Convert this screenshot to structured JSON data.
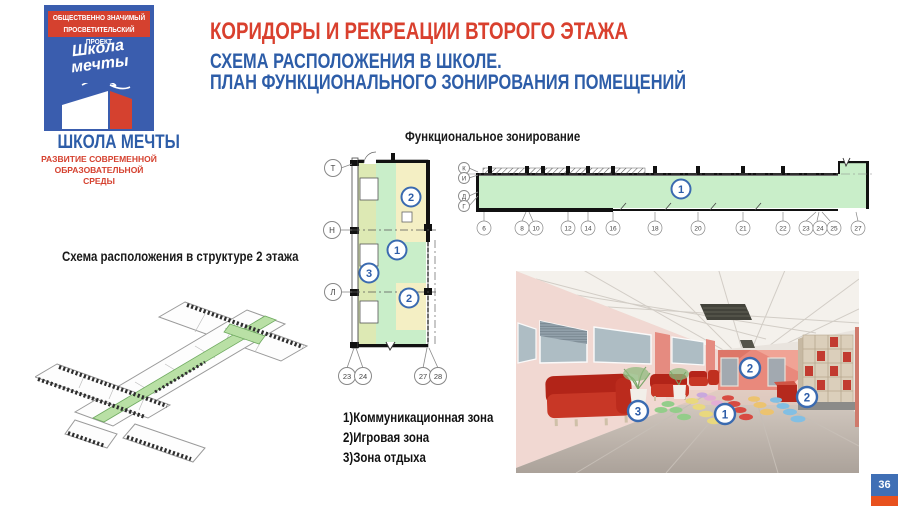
{
  "page": {
    "number": "36"
  },
  "logo": {
    "banner_line1": "ОБЩЕСТВЕННО ЗНАЧИМЫЙ",
    "banner_line2": "ПРОСВЕТИТЕЛЬСКИЙ ПРОЕКТ",
    "script_line1": "Школа",
    "script_line2": "мечты",
    "name": "ШКОЛА МЕЧТЫ",
    "tagline_line1": "РАЗВИТИЕ СОВРЕМЕННОЙ",
    "tagline_line2": "ОБРАЗОВАТЕЛЬНОЙ СРЕДЫ"
  },
  "header": {
    "title": "КОРИДОРЫ И РЕКРЕАЦИИ ВТОРОГО ЭТАЖА",
    "subtitle_line1": "СХЕМА РАСПОЛОЖЕНИЯ В ШКОЛЕ.",
    "subtitle_line2": "ПЛАН ФУНКЦИОНАЛЬНОГО ЗОНИРОВАНИЯ ПОМЕЩЕНИЙ"
  },
  "sections": {
    "functional_zoning_title": "Функциональное зонирование",
    "structure_scheme_title": "Схема расположения в структуре 2 этажа"
  },
  "legend": {
    "items": [
      {
        "label": "1)Коммуникационная зона"
      },
      {
        "label": "2)Игровая зона"
      },
      {
        "label": "3)Зона отдыха"
      }
    ]
  },
  "vertical_plan": {
    "axis_left": [
      "Т",
      "Н",
      "Л"
    ],
    "axis_bottom": [
      "23",
      "24",
      "27",
      "28"
    ],
    "zones": [
      "2",
      "1",
      "3",
      "2"
    ]
  },
  "horizontal_plan": {
    "axis_left": [
      "К",
      "И",
      "Д",
      "Г"
    ],
    "axis_bottom": [
      "6",
      "8",
      "10",
      "12",
      "14",
      "16",
      "18",
      "20",
      "21",
      "22",
      "23",
      "24",
      "25",
      "27"
    ],
    "zone_label": "1"
  },
  "photo": {
    "markers": [
      "3",
      "1",
      "2",
      "2"
    ]
  },
  "colors": {
    "accent_red": "#d9402e",
    "accent_blue": "#2d5da8",
    "zone_green": "#c9eec9",
    "zone_yellow": "#f4efc4",
    "zone_olive": "#dde9b4",
    "badge_blue": "#3f6fb5",
    "badge_red": "#e8511e"
  }
}
